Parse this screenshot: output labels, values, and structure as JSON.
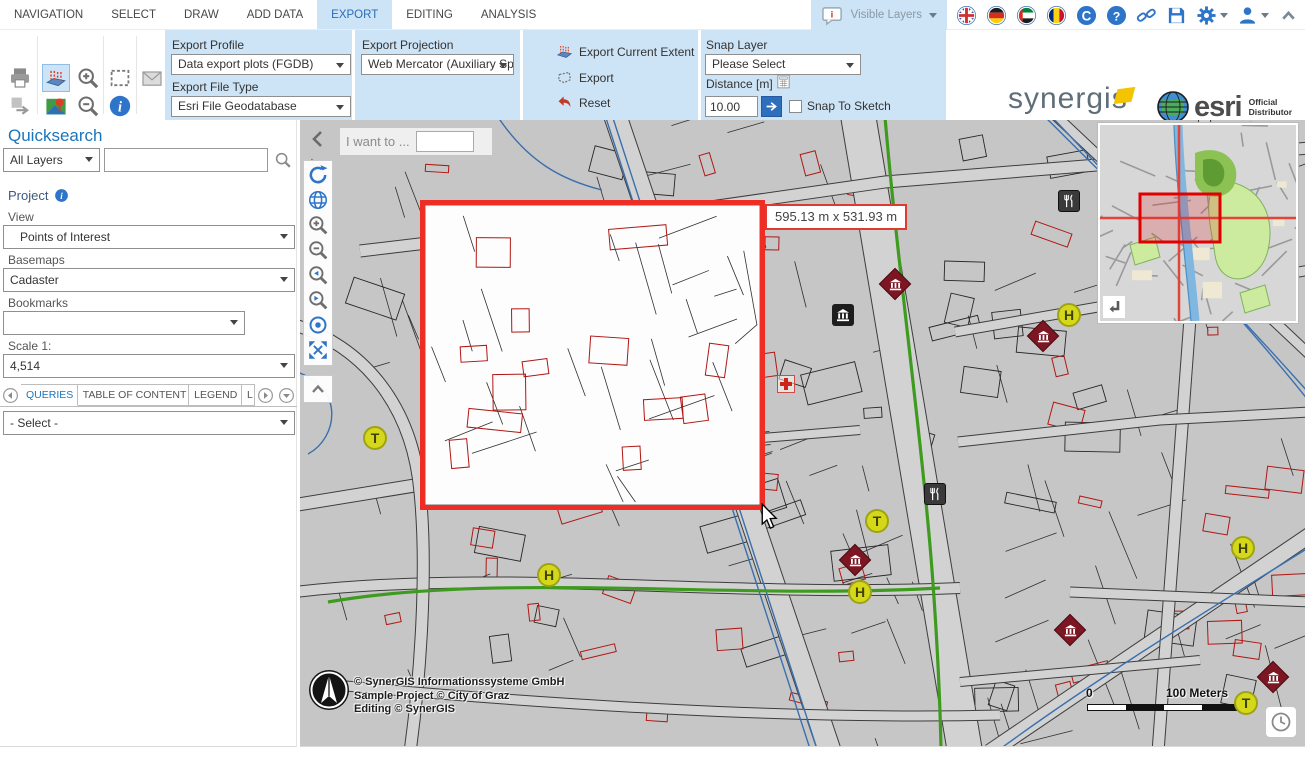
{
  "colors": {
    "accent_blue": "#2e75c9",
    "ribbon_bg": "#cde4f6",
    "selection_red": "#ee2e24",
    "map_bg": "#c6c6c6",
    "route_green": "#3f9b1f",
    "water_blue": "#3a6fae",
    "stop_yellow": "#d5d71b",
    "museum_red": "#7b1622"
  },
  "menubar": {
    "tabs": [
      "NAVIGATION",
      "SELECT",
      "DRAW",
      "ADD DATA",
      "EXPORT",
      "EDITING",
      "ANALYSIS"
    ],
    "active_tab": "EXPORT",
    "visible_layers_label": "Visible Layers"
  },
  "ribbon": {
    "profile_label": "Export Profile",
    "profile_value": "Data export plots (FGDB)",
    "filetype_label": "Export File Type",
    "filetype_value": "Esri File Geodatabase",
    "projection_label": "Export Projection",
    "projection_value": "Web Mercator (Auxiliary Sp...",
    "actions": {
      "current_extent": "Export Current Extent",
      "export": "Export",
      "reset": "Reset"
    },
    "snap": {
      "layer_label": "Snap Layer",
      "layer_value": "Please Select",
      "distance_label": "Distance [m]",
      "distance_value": "10.00",
      "snap_to_sketch": "Snap To Sketch"
    }
  },
  "logos": {
    "synergis": "synergis",
    "esri": "esri",
    "esri_line1": "Official",
    "esri_line2": "Distributor"
  },
  "sidebar": {
    "quicksearch_title": "Quicksearch",
    "layer_filter_value": "All Layers",
    "search_value": "",
    "project_label": "Project",
    "view_label": "View",
    "view_value": "Points of Interest",
    "basemaps_label": "Basemaps",
    "basemaps_value": "Cadaster",
    "bookmarks_label": "Bookmarks",
    "bookmarks_value": "",
    "scale_label": "Scale 1:",
    "scale_value": "4,514",
    "tabs": [
      {
        "label": "QUERIES",
        "active": true
      },
      {
        "label": "TABLE OF CONTENT",
        "active": false
      },
      {
        "label": "LEGEND",
        "active": false
      },
      {
        "label": "L",
        "active": false
      }
    ],
    "query_select_value": "- Select -"
  },
  "map": {
    "i_want_to_label": "I want to ...",
    "measure_tooltip": "595.13 m x 531.93 m",
    "copyright_lines": [
      "© SynerGIS Informationssysteme GmbH",
      "Sample Project © City of Graz",
      "Editing © SynerGIS"
    ],
    "scalebar": {
      "start": "0",
      "end": "100 Meters"
    },
    "markers": [
      {
        "type": "museum-diamond",
        "x": 595,
        "y": 164
      },
      {
        "type": "museum-square",
        "x": 543,
        "y": 195
      },
      {
        "type": "restaurant",
        "x": 769,
        "y": 81
      },
      {
        "type": "museum-diamond",
        "x": 743,
        "y": 216
      },
      {
        "type": "stop-h",
        "x": 769,
        "y": 195
      },
      {
        "type": "pharmacy-cross",
        "x": 486,
        "y": 264
      },
      {
        "type": "stop-t",
        "x": 75,
        "y": 318
      },
      {
        "type": "stop-t",
        "x": 577,
        "y": 401
      },
      {
        "type": "restaurant",
        "x": 635,
        "y": 374
      },
      {
        "type": "museum-diamond",
        "x": 555,
        "y": 440
      },
      {
        "type": "stop-h",
        "x": 249,
        "y": 455
      },
      {
        "type": "stop-h",
        "x": 560,
        "y": 472
      },
      {
        "type": "stop-h",
        "x": 943,
        "y": 428
      },
      {
        "type": "museum-diamond",
        "x": 770,
        "y": 510
      },
      {
        "type": "museum-diamond",
        "x": 973,
        "y": 557
      },
      {
        "type": "stop-t",
        "x": 946,
        "y": 583
      }
    ]
  }
}
